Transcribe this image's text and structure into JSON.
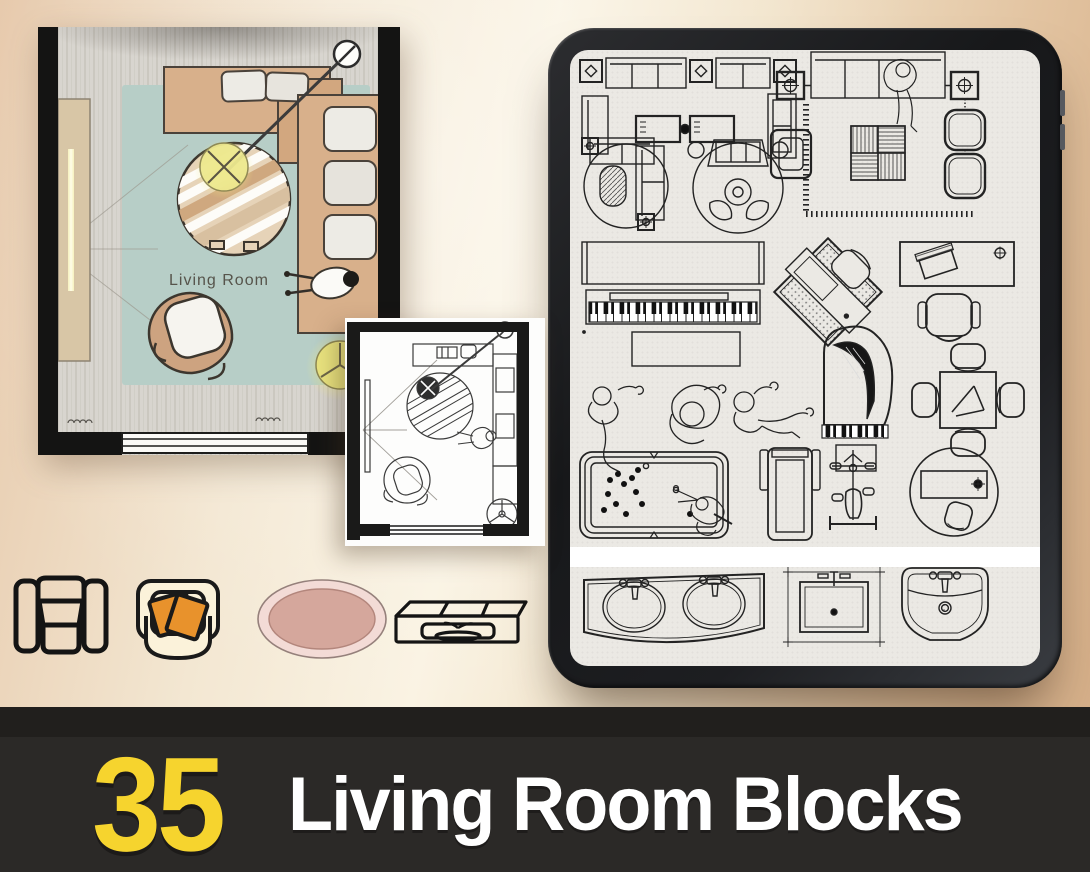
{
  "banner": {
    "count": "35",
    "title": "Living Room Blocks",
    "background": "#2b2927",
    "accent_yellow": "#f6d42e",
    "text_white": "#ffffff"
  },
  "color_plan": {
    "label": "Living Room",
    "colors": {
      "wall": "#141413",
      "floor": "#d8d5cf",
      "rug": "#b7cec7",
      "sofa": "#d8b08b",
      "cushion": "#edebe5",
      "lamp_glow": "#efe98f",
      "tv_console": "#d8c6a6"
    },
    "elements": [
      "l-shaped-sofa",
      "round-striped-rug",
      "arc-floor-lamp",
      "armchair",
      "tv-console",
      "person-sitting",
      "window"
    ]
  },
  "sketch_plan": {
    "style": "black-and-white line art",
    "elements": [
      "desk",
      "l-shaped-sofa",
      "round-striped-rug",
      "arc-floor-lamp",
      "armchair",
      "person",
      "floor-lamp",
      "tv",
      "window"
    ]
  },
  "tablet": {
    "screen_background": "#ebe9e4",
    "blocks": [
      "sofa-set-with-side-tables-and-coffee-tables",
      "area-rug-scene-sofa-person-floor-lamps-parquet-ottomans",
      "l-shaped-sofa-with-round-rug-and-oval-table",
      "round-rug-loveseat-tub-chairs-set",
      "upright-piano-keyboard",
      "piano-bench",
      "diagonal-desk-with-chair-on-dotted-rug",
      "desk-with-laptop",
      "office-chair",
      "person-lounging",
      "person-sitting-crosslegged",
      "person-reclining-legs-out",
      "grand-piano-with-bench",
      "square-table-with-four-chairs",
      "pool-table-with-player",
      "treadmill",
      "exercise-bike",
      "round-rug-with-table-and-pouf",
      "double-sink-vanity",
      "square-sink-counter",
      "pedestal-sink"
    ]
  },
  "icons_row": [
    {
      "name": "armchair-outline-icon",
      "style": "black line art"
    },
    {
      "name": "armchair-orange-cushions-icon",
      "fill": "#fbf2da",
      "cushion": "#e8922c"
    },
    {
      "name": "oval-rug-icon",
      "outer": "#f3dbd6",
      "inner": "#d5a79c"
    },
    {
      "name": "console-table-icon",
      "style": "black line art"
    }
  ]
}
